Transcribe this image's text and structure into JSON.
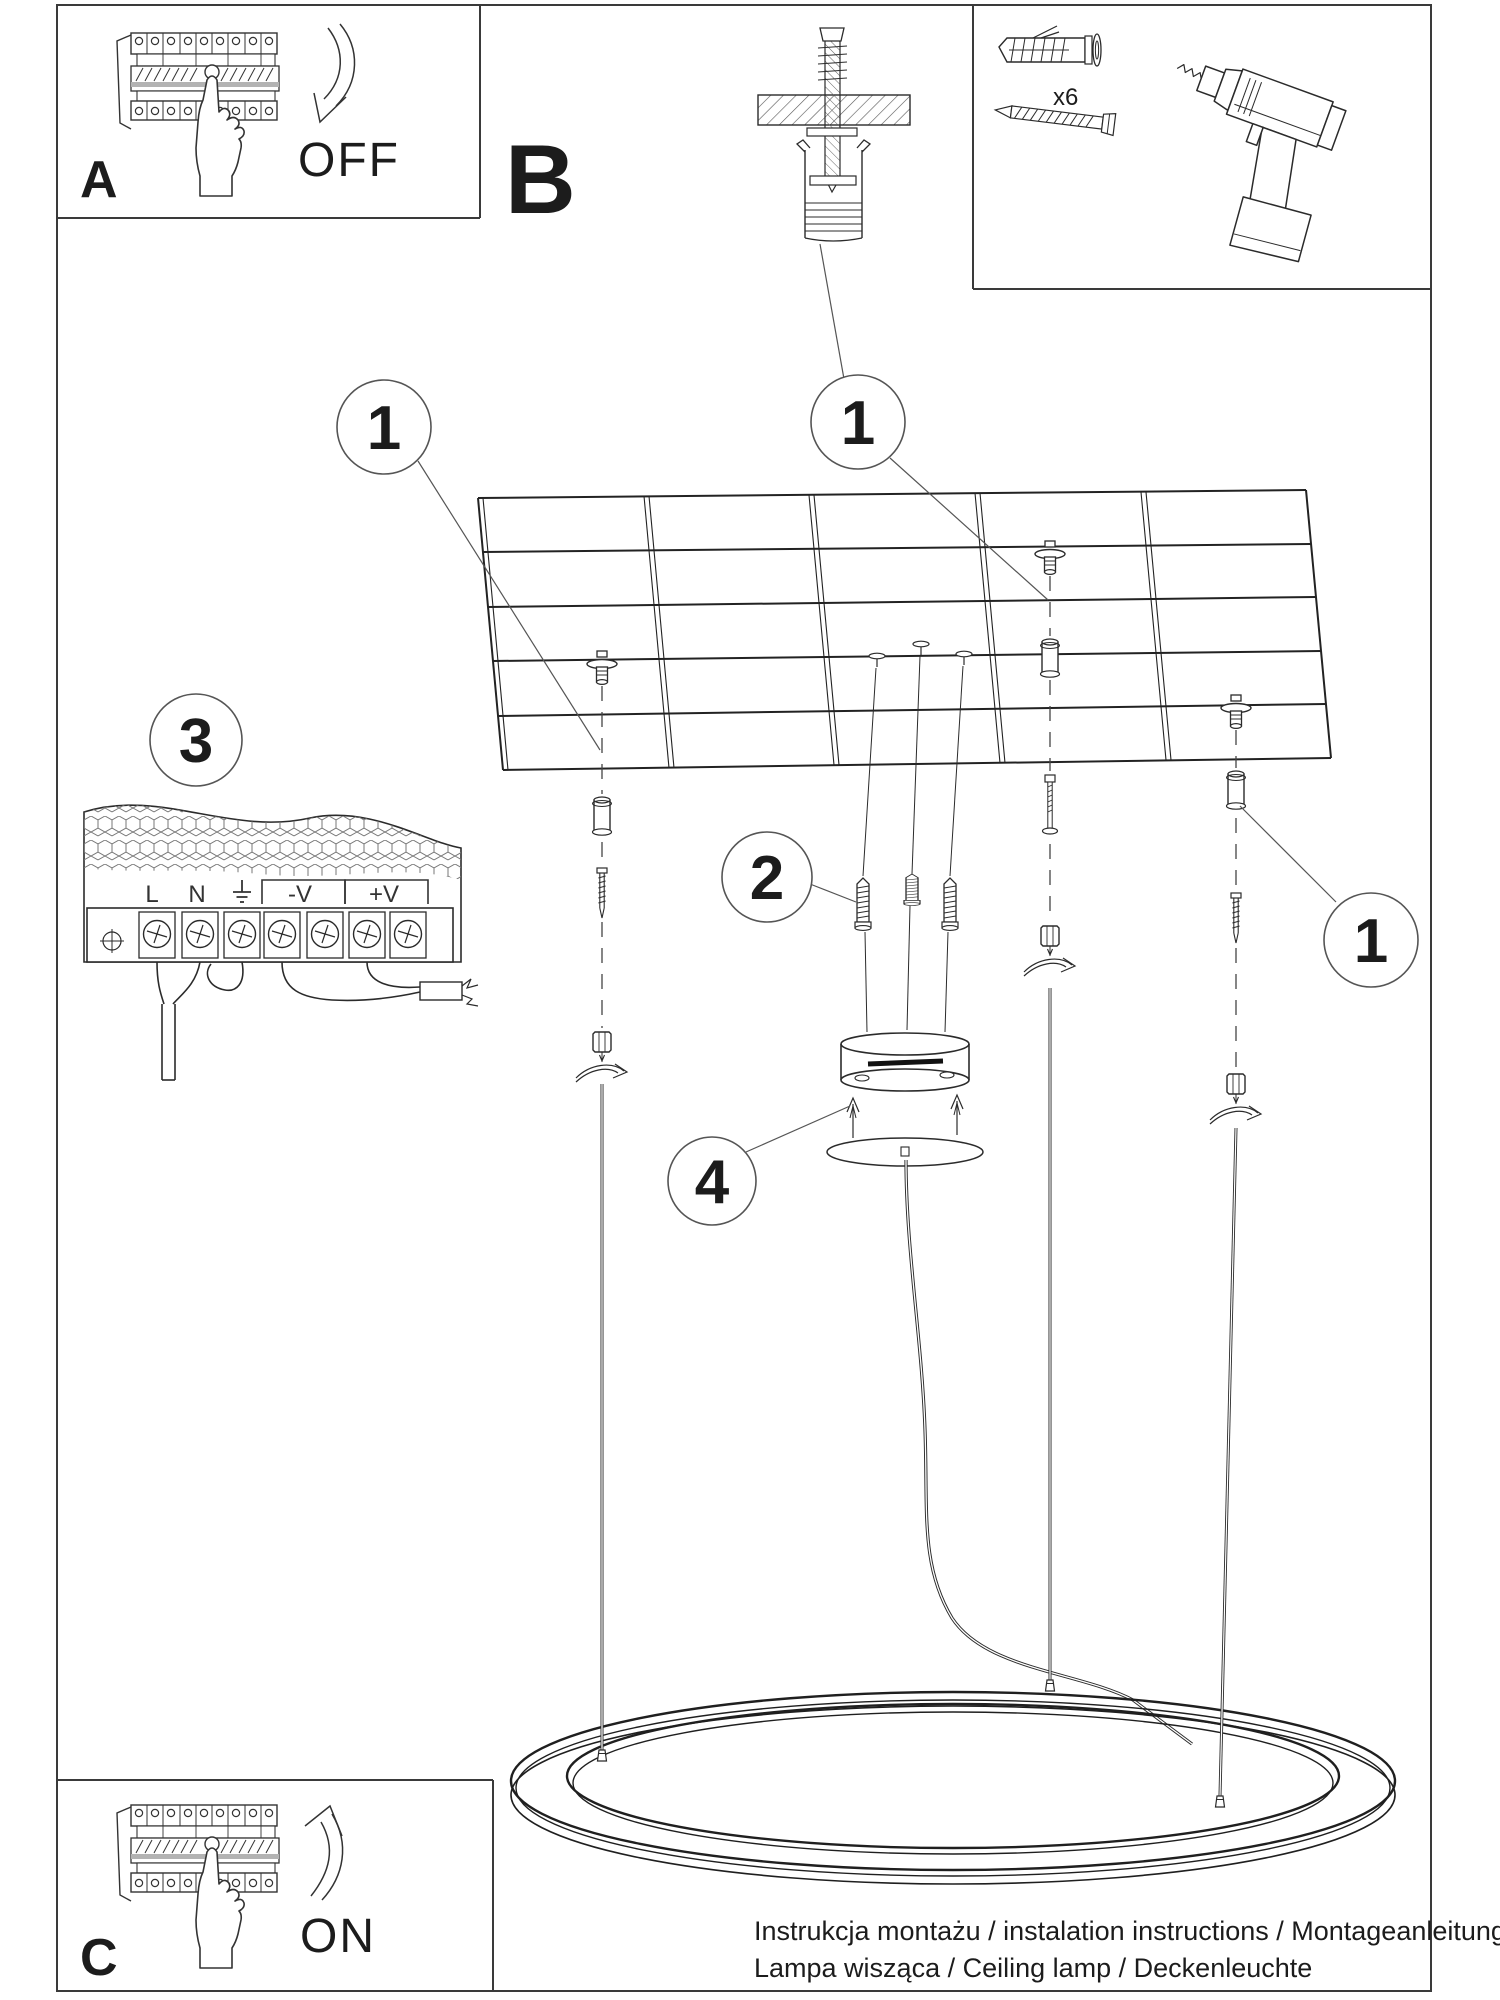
{
  "steps": {
    "a": {
      "label": "A",
      "action": "OFF"
    },
    "b": {
      "label": "B"
    },
    "c": {
      "label": "C",
      "action": "ON"
    }
  },
  "callouts": {
    "part1": "1",
    "part2": "2",
    "part3": "3",
    "part4": "4"
  },
  "kit": {
    "anchor_quantity": "x6"
  },
  "psu": {
    "terminal_l": "L",
    "terminal_n": "N",
    "terminal_neg": "-V",
    "terminal_pos": "+V"
  },
  "footer": {
    "line1": "Instrukcja montażu / instalation instructions / Montageanleitung",
    "line2": "Lampa wisząca / Ceiling lamp / Deckenleuchte"
  },
  "colors": {
    "line": "#2b2b2b",
    "background": "#ffffff"
  }
}
